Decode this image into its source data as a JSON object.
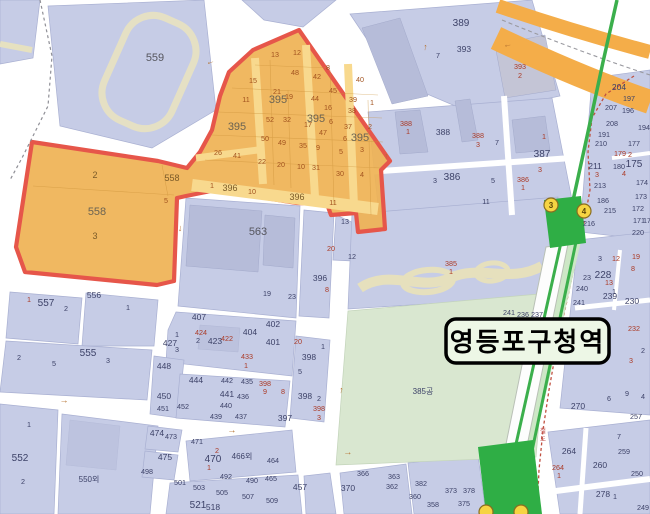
{
  "station_label": "영등포구청역",
  "railway_label": "철도",
  "colors": {
    "zone_fill": "#efb254",
    "zone_border": "#e6564a",
    "zone_road": "#f8d98e",
    "parcel_blue": "#c6cce6",
    "building": "#b6bcd9",
    "road_white": "#ffffff",
    "subway_green": "#3baf4c",
    "platform_green": "#2fae45",
    "park_green": "#d9e7d0",
    "highway_orange": "#f4ad49",
    "exit_yellow": "#f6d442",
    "label_box_bg": "#edf7e6"
  },
  "exits": [
    {
      "t": "3",
      "x": 551,
      "y": 205
    },
    {
      "t": "4",
      "x": 584,
      "y": 211
    },
    {
      "t": "",
      "x": 486,
      "y": 512
    },
    {
      "t": "",
      "x": 521,
      "y": 512
    }
  ],
  "arrows": [
    {
      "g": "←",
      "x": 211,
      "y": 64,
      "r": -18
    },
    {
      "g": "↑",
      "x": 425,
      "y": 50,
      "r": 8
    },
    {
      "g": "←",
      "x": 508,
      "y": 47,
      "r": -12
    },
    {
      "g": "↑",
      "x": 386,
      "y": 159,
      "r": 5
    },
    {
      "g": "↓",
      "x": 180,
      "y": 231,
      "r": 5
    },
    {
      "g": "→",
      "x": 64,
      "y": 403,
      "r": 4
    },
    {
      "g": "→",
      "x": 232,
      "y": 433,
      "r": -4
    },
    {
      "g": "→",
      "x": 348,
      "y": 455,
      "r": -5
    },
    {
      "g": "↑",
      "x": 341,
      "y": 393,
      "r": 8
    }
  ],
  "labels": [
    {
      "t": "559",
      "x": 155,
      "y": 61,
      "c": "xl"
    },
    {
      "t": "389",
      "x": 461,
      "y": 26,
      "c": "lg"
    },
    {
      "t": "393",
      "x": 464,
      "y": 52,
      "c": "md"
    },
    {
      "t": "7",
      "x": 438,
      "y": 58,
      "c": "sm"
    },
    {
      "t": "393",
      "x": 520,
      "y": 69,
      "c": "rd"
    },
    {
      "t": "2",
      "x": 520,
      "y": 78,
      "c": "rd"
    },
    {
      "t": "13",
      "x": 275,
      "y": 57,
      "c": "or"
    },
    {
      "t": "12",
      "x": 297,
      "y": 55,
      "c": "or"
    },
    {
      "t": "48",
      "x": 295,
      "y": 75,
      "c": "or"
    },
    {
      "t": "42",
      "x": 317,
      "y": 79,
      "c": "or"
    },
    {
      "t": "8",
      "x": 328,
      "y": 70,
      "c": "or"
    },
    {
      "t": "15",
      "x": 253,
      "y": 83,
      "c": "or"
    },
    {
      "t": "40",
      "x": 360,
      "y": 82,
      "c": "or"
    },
    {
      "t": "21",
      "x": 277,
      "y": 94,
      "c": "or"
    },
    {
      "t": "19",
      "x": 289,
      "y": 99,
      "c": "or"
    },
    {
      "t": "44",
      "x": 315,
      "y": 101,
      "c": "or"
    },
    {
      "t": "45",
      "x": 333,
      "y": 93,
      "c": "or"
    },
    {
      "t": "39",
      "x": 353,
      "y": 102,
      "c": "or"
    },
    {
      "t": "1",
      "x": 372,
      "y": 105,
      "c": "or"
    },
    {
      "t": "11",
      "x": 246,
      "y": 102,
      "c": "or"
    },
    {
      "t": "16",
      "x": 328,
      "y": 110,
      "c": "or"
    },
    {
      "t": "38",
      "x": 352,
      "y": 113,
      "c": "or"
    },
    {
      "t": "52",
      "x": 270,
      "y": 122,
      "c": "or"
    },
    {
      "t": "32",
      "x": 287,
      "y": 122,
      "c": "or"
    },
    {
      "t": "17",
      "x": 308,
      "y": 127,
      "c": "or"
    },
    {
      "t": "395",
      "x": 237,
      "y": 130,
      "c": "ob"
    },
    {
      "t": "395",
      "x": 278,
      "y": 103,
      "c": "ob"
    },
    {
      "t": "395",
      "x": 316,
      "y": 122,
      "c": "ob"
    },
    {
      "t": "6",
      "x": 331,
      "y": 124,
      "c": "or"
    },
    {
      "t": "395",
      "x": 360,
      "y": 141,
      "c": "ob"
    },
    {
      "t": "37",
      "x": 348,
      "y": 129,
      "c": "or"
    },
    {
      "t": "2",
      "x": 370,
      "y": 129,
      "c": "or"
    },
    {
      "t": "50",
      "x": 265,
      "y": 141,
      "c": "or"
    },
    {
      "t": "49",
      "x": 282,
      "y": 145,
      "c": "or"
    },
    {
      "t": "47",
      "x": 323,
      "y": 135,
      "c": "or"
    },
    {
      "t": "6",
      "x": 345,
      "y": 141,
      "c": "or"
    },
    {
      "t": "26",
      "x": 218,
      "y": 155,
      "c": "or"
    },
    {
      "t": "41",
      "x": 237,
      "y": 158,
      "c": "or"
    },
    {
      "t": "35",
      "x": 303,
      "y": 148,
      "c": "or"
    },
    {
      "t": "9",
      "x": 318,
      "y": 150,
      "c": "or"
    },
    {
      "t": "5",
      "x": 341,
      "y": 154,
      "c": "or"
    },
    {
      "t": "3",
      "x": 362,
      "y": 152,
      "c": "or"
    },
    {
      "t": "22",
      "x": 262,
      "y": 164,
      "c": "or"
    },
    {
      "t": "20",
      "x": 281,
      "y": 167,
      "c": "or"
    },
    {
      "t": "10",
      "x": 301,
      "y": 169,
      "c": "or"
    },
    {
      "t": "31",
      "x": 316,
      "y": 170,
      "c": "or"
    },
    {
      "t": "30",
      "x": 340,
      "y": 176,
      "c": "or"
    },
    {
      "t": "4",
      "x": 362,
      "y": 177,
      "c": "or"
    },
    {
      "t": "1",
      "x": 212,
      "y": 188,
      "c": "or"
    },
    {
      "t": "396",
      "x": 230,
      "y": 191,
      "c": "om"
    },
    {
      "t": "10",
      "x": 252,
      "y": 194,
      "c": "or"
    },
    {
      "t": "396",
      "x": 297,
      "y": 200,
      "c": "om"
    },
    {
      "t": "11",
      "x": 333,
      "y": 205,
      "c": "or"
    },
    {
      "t": "558",
      "x": 172,
      "y": 181,
      "c": "om"
    },
    {
      "t": "5",
      "x": 166,
      "y": 203,
      "c": "or"
    },
    {
      "t": "2",
      "x": 95,
      "y": 178,
      "c": "om"
    },
    {
      "t": "558",
      "x": 97,
      "y": 215,
      "c": "ob"
    },
    {
      "t": "3",
      "x": 95,
      "y": 239,
      "c": "om"
    },
    {
      "t": "388",
      "x": 406,
      "y": 126,
      "c": "rd"
    },
    {
      "t": "1",
      "x": 408,
      "y": 134,
      "c": "rd"
    },
    {
      "t": "388",
      "x": 443,
      "y": 135,
      "c": "md"
    },
    {
      "t": "388",
      "x": 478,
      "y": 138,
      "c": "rd"
    },
    {
      "t": "3",
      "x": 478,
      "y": 147,
      "c": "rd"
    },
    {
      "t": "7",
      "x": 497,
      "y": 145,
      "c": "sm"
    },
    {
      "t": "1",
      "x": 544,
      "y": 139,
      "c": "rd"
    },
    {
      "t": "387",
      "x": 542,
      "y": 157,
      "c": "lg"
    },
    {
      "t": "3",
      "x": 540,
      "y": 172,
      "c": "rd"
    },
    {
      "t": "386",
      "x": 452,
      "y": 180,
      "c": "lg"
    },
    {
      "t": "3",
      "x": 435,
      "y": 183,
      "c": "sm"
    },
    {
      "t": "5",
      "x": 493,
      "y": 183,
      "c": "sm"
    },
    {
      "t": "386",
      "x": 523,
      "y": 182,
      "c": "rd"
    },
    {
      "t": "1",
      "x": 523,
      "y": 190,
      "c": "rd"
    },
    {
      "t": "11",
      "x": 486,
      "y": 204,
      "c": "sm"
    },
    {
      "t": "13",
      "x": 345,
      "y": 224,
      "c": "sm"
    },
    {
      "t": "563",
      "x": 258,
      "y": 235,
      "c": "xl"
    },
    {
      "t": "20",
      "x": 331,
      "y": 251,
      "c": "rd"
    },
    {
      "t": "12",
      "x": 352,
      "y": 259,
      "c": "sm"
    },
    {
      "t": "396",
      "x": 320,
      "y": 281,
      "c": "md"
    },
    {
      "t": "8",
      "x": 327,
      "y": 292,
      "c": "rd"
    },
    {
      "t": "19",
      "x": 267,
      "y": 296,
      "c": "sm"
    },
    {
      "t": "23",
      "x": 292,
      "y": 299,
      "c": "sm"
    },
    {
      "t": "385",
      "x": 451,
      "y": 266,
      "c": "rd"
    },
    {
      "t": "1",
      "x": 451,
      "y": 274,
      "c": "rd"
    },
    {
      "t": "385공",
      "x": 423,
      "y": 394,
      "c": "ko"
    },
    {
      "t": "1",
      "x": 29,
      "y": 302,
      "c": "rd"
    },
    {
      "t": "557",
      "x": 46,
      "y": 306,
      "c": "lg"
    },
    {
      "t": "2",
      "x": 66,
      "y": 311,
      "c": "sm"
    },
    {
      "t": "556",
      "x": 94,
      "y": 298,
      "c": "md"
    },
    {
      "t": "1",
      "x": 128,
      "y": 310,
      "c": "sm"
    },
    {
      "t": "2",
      "x": 19,
      "y": 360,
      "c": "sm"
    },
    {
      "t": "5",
      "x": 54,
      "y": 366,
      "c": "sm"
    },
    {
      "t": "555",
      "x": 88,
      "y": 356,
      "c": "lg"
    },
    {
      "t": "3",
      "x": 108,
      "y": 363,
      "c": "sm"
    },
    {
      "t": "1",
      "x": 29,
      "y": 427,
      "c": "sm"
    },
    {
      "t": "552",
      "x": 20,
      "y": 461,
      "c": "lg"
    },
    {
      "t": "2",
      "x": 23,
      "y": 484,
      "c": "sm"
    },
    {
      "t": "550외",
      "x": 89,
      "y": 482,
      "c": "ko"
    },
    {
      "t": "407",
      "x": 199,
      "y": 320,
      "c": "md"
    },
    {
      "t": "424",
      "x": 201,
      "y": 335,
      "c": "rd"
    },
    {
      "t": "423",
      "x": 215,
      "y": 344,
      "c": "md"
    },
    {
      "t": "422",
      "x": 227,
      "y": 341,
      "c": "rd"
    },
    {
      "t": "1",
      "x": 177,
      "y": 337,
      "c": "sm"
    },
    {
      "t": "427",
      "x": 170,
      "y": 346,
      "c": "md"
    },
    {
      "t": "2",
      "x": 198,
      "y": 343,
      "c": "sm"
    },
    {
      "t": "3",
      "x": 177,
      "y": 352,
      "c": "sm"
    },
    {
      "t": "404",
      "x": 250,
      "y": 335,
      "c": "md"
    },
    {
      "t": "402",
      "x": 273,
      "y": 327,
      "c": "md"
    },
    {
      "t": "401",
      "x": 273,
      "y": 345,
      "c": "md"
    },
    {
      "t": "433",
      "x": 247,
      "y": 359,
      "c": "rd"
    },
    {
      "t": "1",
      "x": 246,
      "y": 368,
      "c": "rd"
    },
    {
      "t": "20",
      "x": 298,
      "y": 344,
      "c": "rd"
    },
    {
      "t": "1",
      "x": 323,
      "y": 349,
      "c": "sm"
    },
    {
      "t": "398",
      "x": 309,
      "y": 360,
      "c": "md"
    },
    {
      "t": "5",
      "x": 300,
      "y": 374,
      "c": "sm"
    },
    {
      "t": "448",
      "x": 164,
      "y": 369,
      "c": "md"
    },
    {
      "t": "450",
      "x": 164,
      "y": 399,
      "c": "md"
    },
    {
      "t": "451",
      "x": 163,
      "y": 411,
      "c": "sm"
    },
    {
      "t": "452",
      "x": 183,
      "y": 409,
      "c": "sm"
    },
    {
      "t": "444",
      "x": 196,
      "y": 383,
      "c": "md"
    },
    {
      "t": "442",
      "x": 227,
      "y": 383,
      "c": "sm"
    },
    {
      "t": "435",
      "x": 247,
      "y": 384,
      "c": "sm"
    },
    {
      "t": "398",
      "x": 265,
      "y": 386,
      "c": "rd"
    },
    {
      "t": "9",
      "x": 265,
      "y": 394,
      "c": "rd"
    },
    {
      "t": "441",
      "x": 227,
      "y": 397,
      "c": "md"
    },
    {
      "t": "436",
      "x": 243,
      "y": 399,
      "c": "sm"
    },
    {
      "t": "8",
      "x": 283,
      "y": 394,
      "c": "rd"
    },
    {
      "t": "398",
      "x": 305,
      "y": 399,
      "c": "md"
    },
    {
      "t": "2",
      "x": 319,
      "y": 401,
      "c": "sm"
    },
    {
      "t": "440",
      "x": 226,
      "y": 408,
      "c": "sm"
    },
    {
      "t": "439",
      "x": 216,
      "y": 419,
      "c": "sm"
    },
    {
      "t": "437",
      "x": 241,
      "y": 419,
      "c": "sm"
    },
    {
      "t": "397",
      "x": 285,
      "y": 421,
      "c": "md"
    },
    {
      "t": "398",
      "x": 319,
      "y": 411,
      "c": "rd"
    },
    {
      "t": "3",
      "x": 319,
      "y": 420,
      "c": "rd"
    },
    {
      "t": "474",
      "x": 157,
      "y": 436,
      "c": "md"
    },
    {
      "t": "473",
      "x": 171,
      "y": 439,
      "c": "sm"
    },
    {
      "t": "471",
      "x": 197,
      "y": 444,
      "c": "sm"
    },
    {
      "t": "475",
      "x": 165,
      "y": 460,
      "c": "md"
    },
    {
      "t": "498",
      "x": 147,
      "y": 474,
      "c": "sm"
    },
    {
      "t": "2",
      "x": 217,
      "y": 453,
      "c": "rd"
    },
    {
      "t": "470",
      "x": 213,
      "y": 462,
      "c": "lg"
    },
    {
      "t": "1",
      "x": 209,
      "y": 470,
      "c": "rd"
    },
    {
      "t": "466외",
      "x": 242,
      "y": 459,
      "c": "ko"
    },
    {
      "t": "464",
      "x": 273,
      "y": 463,
      "c": "sm"
    },
    {
      "t": "492",
      "x": 226,
      "y": 479,
      "c": "sm"
    },
    {
      "t": "490",
      "x": 252,
      "y": 483,
      "c": "sm"
    },
    {
      "t": "465",
      "x": 271,
      "y": 481,
      "c": "sm"
    },
    {
      "t": "501",
      "x": 180,
      "y": 485,
      "c": "sm"
    },
    {
      "t": "503",
      "x": 199,
      "y": 490,
      "c": "sm"
    },
    {
      "t": "505",
      "x": 222,
      "y": 495,
      "c": "sm"
    },
    {
      "t": "507",
      "x": 248,
      "y": 499,
      "c": "sm"
    },
    {
      "t": "509",
      "x": 272,
      "y": 503,
      "c": "sm"
    },
    {
      "t": "521",
      "x": 198,
      "y": 508,
      "c": "lg"
    },
    {
      "t": "518",
      "x": 213,
      "y": 510,
      "c": "md"
    },
    {
      "t": "457",
      "x": 300,
      "y": 490,
      "c": "md"
    },
    {
      "t": "370",
      "x": 348,
      "y": 491,
      "c": "md"
    },
    {
      "t": "366",
      "x": 363,
      "y": 476,
      "c": "sm"
    },
    {
      "t": "363",
      "x": 394,
      "y": 479,
      "c": "sm"
    },
    {
      "t": "362",
      "x": 392,
      "y": 489,
      "c": "sm"
    },
    {
      "t": "382",
      "x": 421,
      "y": 486,
      "c": "sm"
    },
    {
      "t": "360",
      "x": 415,
      "y": 499,
      "c": "sm"
    },
    {
      "t": "373",
      "x": 451,
      "y": 493,
      "c": "sm"
    },
    {
      "t": "378",
      "x": 469,
      "y": 493,
      "c": "sm"
    },
    {
      "t": "358",
      "x": 433,
      "y": 507,
      "c": "sm"
    },
    {
      "t": "375",
      "x": 464,
      "y": 506,
      "c": "sm"
    },
    {
      "t": "204",
      "x": 619,
      "y": 90,
      "c": "md"
    },
    {
      "t": "197",
      "x": 629,
      "y": 101,
      "c": "sm"
    },
    {
      "t": "207",
      "x": 611,
      "y": 110,
      "c": "sm"
    },
    {
      "t": "196",
      "x": 628,
      "y": 113,
      "c": "sm"
    },
    {
      "t": "208",
      "x": 612,
      "y": 126,
      "c": "sm"
    },
    {
      "t": "194",
      "x": 644,
      "y": 130,
      "c": "sm"
    },
    {
      "t": "191",
      "x": 604,
      "y": 137,
      "c": "sm"
    },
    {
      "t": "210",
      "x": 601,
      "y": 146,
      "c": "sm"
    },
    {
      "t": "177",
      "x": 634,
      "y": 146,
      "c": "sm"
    },
    {
      "t": "179",
      "x": 620,
      "y": 156,
      "c": "rd"
    },
    {
      "t": "2",
      "x": 630,
      "y": 157,
      "c": "rd"
    },
    {
      "t": "211",
      "x": 595,
      "y": 169,
      "c": "md"
    },
    {
      "t": "180",
      "x": 619,
      "y": 169,
      "c": "sm"
    },
    {
      "t": "175",
      "x": 634,
      "y": 167,
      "c": "lg"
    },
    {
      "t": "4",
      "x": 624,
      "y": 176,
      "c": "rd"
    },
    {
      "t": "3",
      "x": 597,
      "y": 177,
      "c": "rd"
    },
    {
      "t": "213",
      "x": 600,
      "y": 188,
      "c": "sm"
    },
    {
      "t": "174",
      "x": 642,
      "y": 185,
      "c": "sm"
    },
    {
      "t": "186",
      "x": 603,
      "y": 203,
      "c": "sm"
    },
    {
      "t": "173",
      "x": 641,
      "y": 199,
      "c": "sm"
    },
    {
      "t": "215",
      "x": 610,
      "y": 213,
      "c": "sm"
    },
    {
      "t": "172",
      "x": 638,
      "y": 211,
      "c": "sm"
    },
    {
      "t": "171",
      "x": 639,
      "y": 223,
      "c": "sm"
    },
    {
      "t": "216",
      "x": 589,
      "y": 226,
      "c": "sm"
    },
    {
      "t": "170",
      "x": 649,
      "y": 223,
      "c": "sm"
    },
    {
      "t": "220",
      "x": 638,
      "y": 235,
      "c": "sm"
    },
    {
      "t": "3",
      "x": 600,
      "y": 261,
      "c": "sm"
    },
    {
      "t": "12",
      "x": 616,
      "y": 261,
      "c": "rd"
    },
    {
      "t": "19",
      "x": 636,
      "y": 259,
      "c": "rd"
    },
    {
      "t": "23",
      "x": 587,
      "y": 280,
      "c": "sm"
    },
    {
      "t": "228",
      "x": 603,
      "y": 278,
      "c": "lg"
    },
    {
      "t": "8",
      "x": 633,
      "y": 271,
      "c": "rd"
    },
    {
      "t": "13",
      "x": 609,
      "y": 285,
      "c": "rd"
    },
    {
      "t": "240",
      "x": 582,
      "y": 291,
      "c": "sm"
    },
    {
      "t": "239",
      "x": 610,
      "y": 299,
      "c": "md"
    },
    {
      "t": "241",
      "x": 579,
      "y": 305,
      "c": "sm"
    },
    {
      "t": "230",
      "x": 632,
      "y": 304,
      "c": "md"
    },
    {
      "t": "1",
      "x": 614,
      "y": 294,
      "c": "sm"
    },
    {
      "t": "241",
      "x": 509,
      "y": 315,
      "c": "sm"
    },
    {
      "t": "236",
      "x": 523,
      "y": 317,
      "c": "sm"
    },
    {
      "t": "237",
      "x": 537,
      "y": 317,
      "c": "sm"
    },
    {
      "t": "232",
      "x": 634,
      "y": 331,
      "c": "rd"
    },
    {
      "t": "2",
      "x": 643,
      "y": 353,
      "c": "sm"
    },
    {
      "t": "3",
      "x": 631,
      "y": 363,
      "c": "rd"
    },
    {
      "t": "9",
      "x": 627,
      "y": 396,
      "c": "sm"
    },
    {
      "t": "6",
      "x": 609,
      "y": 401,
      "c": "sm"
    },
    {
      "t": "4",
      "x": 643,
      "y": 399,
      "c": "sm"
    },
    {
      "t": "270",
      "x": 578,
      "y": 409,
      "c": "md"
    },
    {
      "t": "257",
      "x": 636,
      "y": 419,
      "c": "sm"
    },
    {
      "t": "7",
      "x": 619,
      "y": 439,
      "c": "sm"
    },
    {
      "t": "264",
      "x": 569,
      "y": 454,
      "c": "md"
    },
    {
      "t": "259",
      "x": 624,
      "y": 454,
      "c": "sm"
    },
    {
      "t": "260",
      "x": 600,
      "y": 468,
      "c": "md"
    },
    {
      "t": "264",
      "x": 558,
      "y": 470,
      "c": "rd"
    },
    {
      "t": "1",
      "x": 559,
      "y": 478,
      "c": "rd"
    },
    {
      "t": "250",
      "x": 637,
      "y": 476,
      "c": "sm"
    },
    {
      "t": "278",
      "x": 603,
      "y": 497,
      "c": "md"
    },
    {
      "t": "1",
      "x": 615,
      "y": 499,
      "c": "sm"
    },
    {
      "t": "249",
      "x": 643,
      "y": 510,
      "c": "sm"
    }
  ]
}
